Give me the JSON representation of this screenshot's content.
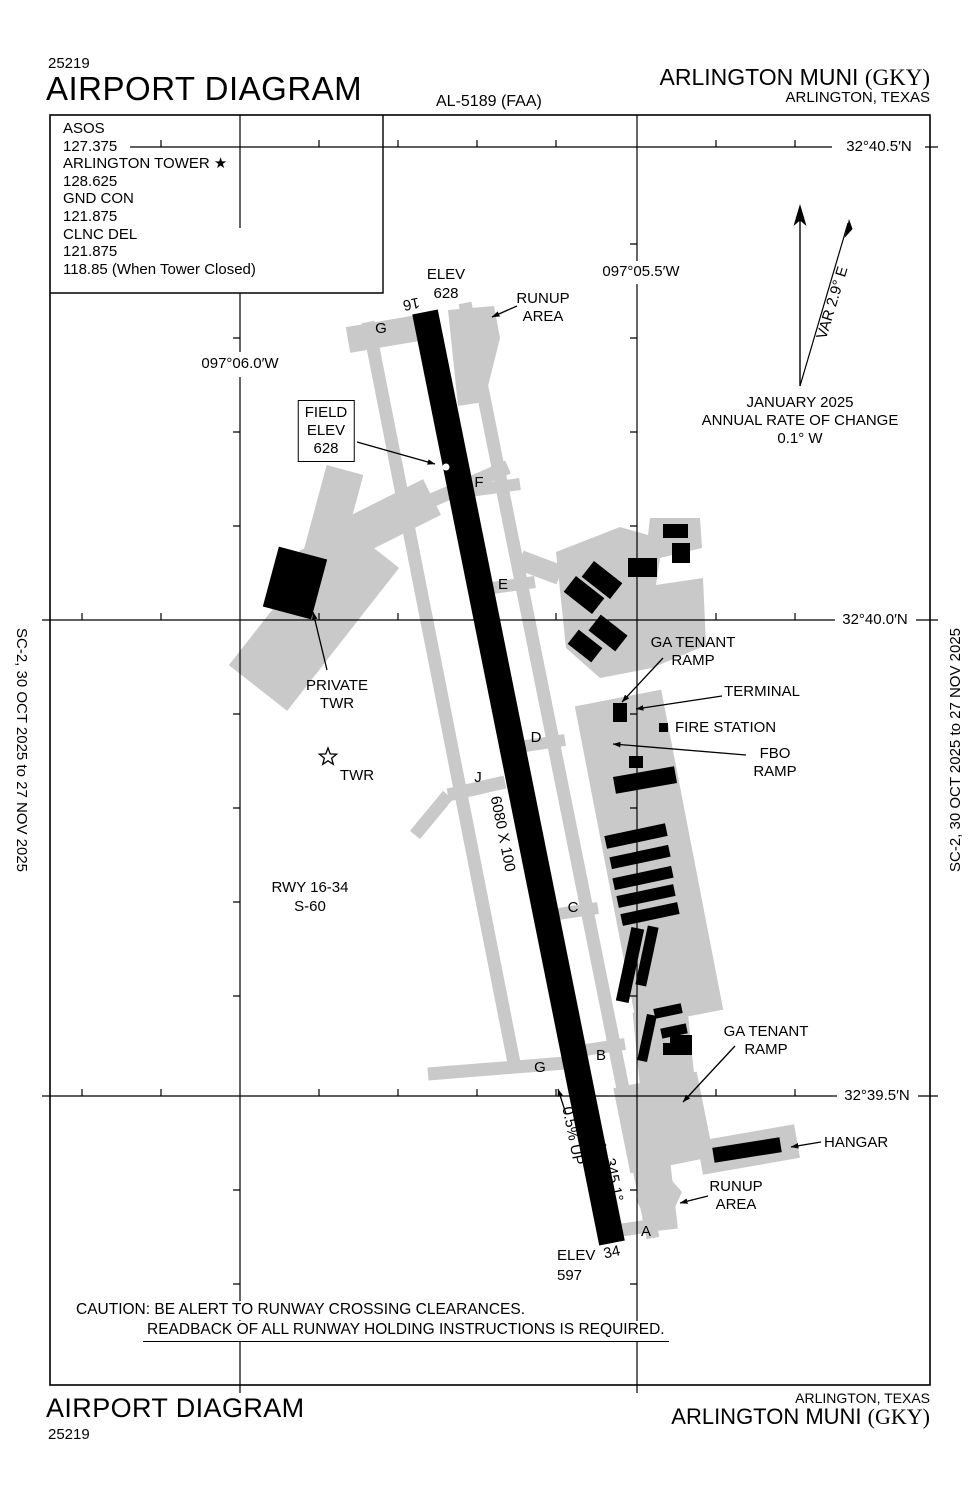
{
  "header": {
    "chart_number": "25219",
    "title": "AIRPORT DIAGRAM",
    "procedure_id": "AL-5189 (FAA)",
    "airport_name": "ARLINGTON MUNI",
    "airport_icao": "(GKY)",
    "city": "ARLINGTON, TEXAS"
  },
  "footer": {
    "title": "AIRPORT DIAGRAM",
    "chart_number": "25219",
    "city": "ARLINGTON, TEXAS",
    "airport_name": "ARLINGTON MUNI",
    "airport_icao": "(GKY)"
  },
  "edge_note": "SC-2,  30 OCT 2025  to  27 NOV 2025",
  "frequencies": {
    "lines": [
      "ASOS",
      "127.375",
      "ARLINGTON TOWER ★",
      "128.625",
      "GND CON",
      "121.875",
      "CLNC DEL",
      "121.875",
      "118.85 (When Tower Closed)"
    ]
  },
  "grid": {
    "lats": [
      "32°40.5′N",
      "32°40.0′N",
      "32°39.5′N"
    ],
    "lons": [
      "097°06.0′W",
      "097°05.5′W"
    ]
  },
  "compass": {
    "variation": "VAR 2.9° E",
    "date": "JANUARY 2025",
    "rate1": "ANNUAL RATE OF CHANGE",
    "rate2": "0.1° W"
  },
  "runway": {
    "num_16": "16",
    "num_34": "34",
    "hdg_16": "165.1°",
    "hdg_34": "345.1°",
    "dimensions": "6080 X 100",
    "slope": "0.5% UP",
    "elev_16_1": "ELEV",
    "elev_16_2": "628",
    "elev_34_1": "ELEV",
    "elev_34_2": "597",
    "info_1": "RWY 16-34",
    "info_2": "S-60"
  },
  "field_elev": {
    "l1": "FIELD",
    "l2": "ELEV",
    "l3": "628"
  },
  "features": {
    "runup_1": "RUNUP",
    "runup_2": "AREA",
    "ga_1": "GA TENANT",
    "ga_2": "RAMP",
    "terminal": "TERMINAL",
    "fire_station": "FIRE STATION",
    "fbo_1": "FBO",
    "fbo_2": "RAMP",
    "private_1": "PRIVATE",
    "private_2": "TWR",
    "twr": "TWR",
    "hangar": "HANGAR"
  },
  "taxiways": {
    "a": "A",
    "b": "B",
    "c": "C",
    "d": "D",
    "e": "E",
    "f": "F",
    "g_top": "G",
    "g_bottom": "G",
    "j": "J"
  },
  "caution": {
    "line1": "CAUTION: BE ALERT TO RUNWAY CROSSING CLEARANCES.",
    "line2": "READBACK OF ALL RUNWAY HOLDING INSTRUCTIONS IS REQUIRED."
  },
  "colors": {
    "pavement": "#c9c9c9",
    "ink": "#000000"
  }
}
